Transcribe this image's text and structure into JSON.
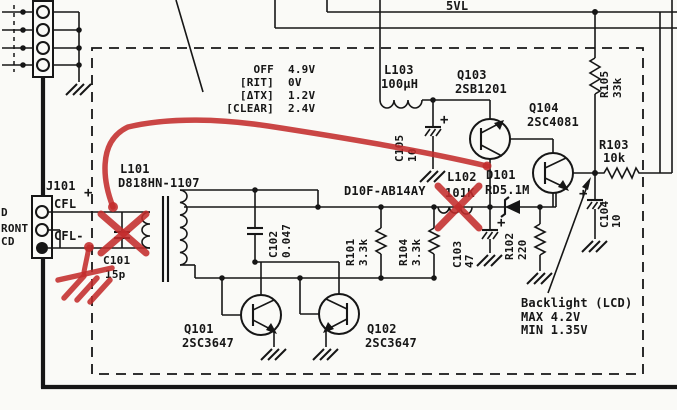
{
  "schematic": {
    "paper_color": "#fafaf7",
    "ink_color": "#161616",
    "annotation_color": "#c32c2c",
    "power_rail_label": "5VL",
    "cut_labels": {
      "l1": "D",
      "l2": "RONT",
      "l3": "CD"
    },
    "j101": {
      "ref": "J101",
      "pos_label": "CFL",
      "pos_sign": "+",
      "neg_label": "CFL-"
    },
    "plus_sign": "+",
    "voltage_table": {
      "rows": [
        {
          "label": "OFF",
          "value": "4.9V"
        },
        {
          "label": "[RIT]",
          "value": "0V"
        },
        {
          "label": "[ΔTX]",
          "value": "1.2V"
        },
        {
          "label": "[CLEAR]",
          "value": "2.4V"
        }
      ]
    },
    "components": {
      "l101": {
        "ref": "L101",
        "value": "D818HN-1107"
      },
      "c101": {
        "ref": "C101",
        "value": "15p"
      },
      "l103": {
        "ref": "L103",
        "value": "100µH"
      },
      "c105": {
        "ref": "C105",
        "value": "10"
      },
      "q103": {
        "ref": "Q103",
        "value": "2SB1201"
      },
      "q104": {
        "ref": "Q104",
        "value": "2SC4081"
      },
      "r105": {
        "ref": "R105",
        "value": "33k"
      },
      "r103": {
        "ref": "R103",
        "value": "10k"
      },
      "c104": {
        "ref": "C104",
        "value": "10"
      },
      "c102": {
        "ref": "C102",
        "value": "0.047"
      },
      "r101": {
        "ref": "R101",
        "value": "3.3k"
      },
      "r104": {
        "ref": "R104",
        "value": "3.3k"
      },
      "diode_line": "D10F-AB14AY",
      "l102": {
        "ref": "L102",
        "value": "101K"
      },
      "d101": {
        "ref": "D101",
        "value": "RD5.1M"
      },
      "c103": {
        "ref": "C103",
        "value": "47"
      },
      "r102": {
        "ref": "R102",
        "value": "220"
      },
      "q101": {
        "ref": "Q101",
        "value": "2SC3647"
      },
      "q102": {
        "ref": "Q102",
        "value": "2SC3647"
      }
    },
    "backlight_note": {
      "title": "Backlight (LCD)",
      "max": "MAX 4.2V",
      "min": "MIN 1.35V"
    }
  }
}
